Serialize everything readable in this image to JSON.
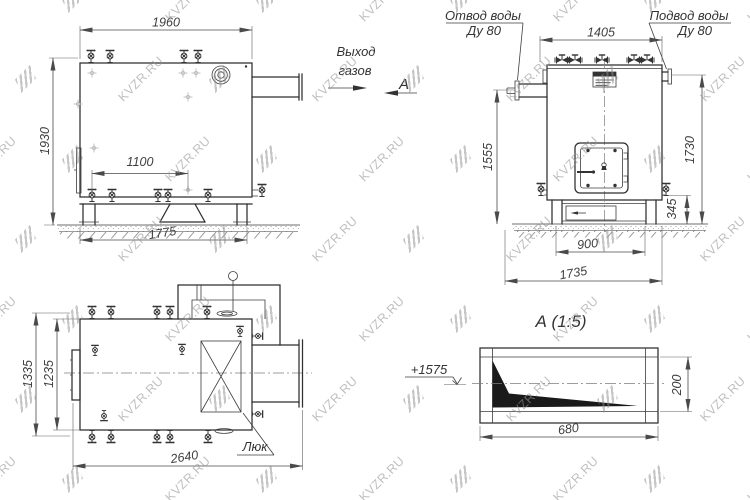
{
  "watermark": {
    "text": "KVZR.RU"
  },
  "side_view": {
    "dim_width_top": "1960",
    "dim_height_left": "1930",
    "dim_support_span": "1100",
    "dim_base_width": "1775"
  },
  "gas_outlet_label": {
    "line1": "Выход",
    "line2": "газов"
  },
  "view_marker": {
    "label": "А"
  },
  "front_view": {
    "outlet_label_line1": "Отвод воды",
    "outlet_label_line2": "Ду 80",
    "inlet_label_line1": "Подвод воды",
    "inlet_label_line2": "Ду 80",
    "dim_width_top": "1405",
    "dim_height_left": "1555",
    "dim_height_right": "1730",
    "dim_base_height": "345",
    "dim_base_inner": "900",
    "dim_base_outer": "1735"
  },
  "top_view": {
    "dim_height_outer": "1335",
    "dim_height_inner": "1235",
    "dim_length": "2640",
    "hatch_label": "Люк"
  },
  "section_view": {
    "title": "А (1:5)",
    "elevation_mark": "+1575",
    "dim_width": "680",
    "dim_height": "200"
  }
}
